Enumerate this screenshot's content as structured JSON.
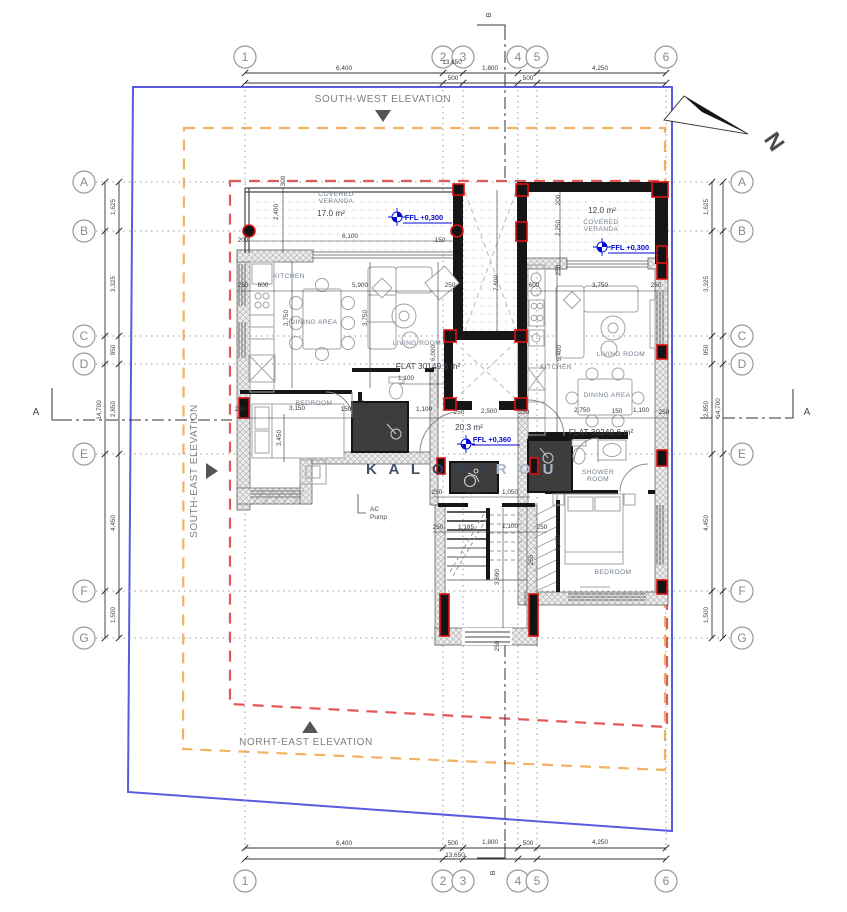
{
  "colors": {
    "boundary_blue": "#5a5ae0",
    "setback_orange": "#f2b263",
    "envelope_red": "#e65555",
    "ffl_blue": "#0009d0",
    "column_red": "#dd1111",
    "wall_black": "#161616"
  },
  "north": {
    "label": "N"
  },
  "sections": {
    "a": "A",
    "b": "B"
  },
  "elevations": {
    "south_west": "SOUTH-WEST ELEVATION",
    "north_east": "NORHT-EAST ELEVATION",
    "south_east": "SOUTH-EAST ELEVATION"
  },
  "watermark": {
    "strong": "K A L O G I",
    "faint": "R O U"
  },
  "ac_note": {
    "line1": "AC",
    "line2": "Pump"
  },
  "grid": {
    "cols": [
      {
        "label": "1",
        "x": 245
      },
      {
        "label": "2",
        "x": 443
      },
      {
        "label": "3",
        "x": 463
      },
      {
        "label": "4",
        "x": 518
      },
      {
        "label": "5",
        "x": 537
      },
      {
        "label": "6",
        "x": 666
      }
    ],
    "rows": [
      {
        "label": "A",
        "y": 182
      },
      {
        "label": "B",
        "y": 231
      },
      {
        "label": "C",
        "y": 336
      },
      {
        "label": "D",
        "y": 364
      },
      {
        "label": "E",
        "y": 454
      },
      {
        "label": "F",
        "y": 591
      },
      {
        "label": "G",
        "y": 638
      }
    ]
  },
  "dim_labels": [
    {
      "t": "6,400",
      "x": 344,
      "y": 70
    },
    {
      "t": "13,650",
      "x": 452,
      "y": 64
    },
    {
      "t": "500",
      "x": 453,
      "y": 80
    },
    {
      "t": "1,800",
      "x": 490,
      "y": 70
    },
    {
      "t": "500",
      "x": 528,
      "y": 80
    },
    {
      "t": "4,250",
      "x": 600,
      "y": 70
    },
    {
      "t": "6,400",
      "x": 344,
      "y": 845
    },
    {
      "t": "500",
      "x": 453,
      "y": 845
    },
    {
      "t": "1,800",
      "x": 490,
      "y": 844
    },
    {
      "t": "500",
      "x": 528,
      "y": 845
    },
    {
      "t": "4,250",
      "x": 600,
      "y": 844
    },
    {
      "t": "13,650",
      "x": 455,
      "y": 857
    },
    {
      "t": "1,625",
      "x": 115,
      "y": 207,
      "r": 1
    },
    {
      "t": "3,325",
      "x": 115,
      "y": 284,
      "r": 1
    },
    {
      "t": "950",
      "x": 115,
      "y": 350,
      "r": 1
    },
    {
      "t": "2,850",
      "x": 115,
      "y": 409,
      "r": 1
    },
    {
      "t": "4,450",
      "x": 115,
      "y": 523,
      "r": 1
    },
    {
      "t": "1,500",
      "x": 115,
      "y": 615,
      "r": 1
    },
    {
      "t": "14,700",
      "x": 101,
      "y": 410,
      "r": 1
    },
    {
      "t": "1,625",
      "x": 708,
      "y": 207,
      "r": 1
    },
    {
      "t": "3,325",
      "x": 708,
      "y": 284,
      "r": 1
    },
    {
      "t": "950",
      "x": 708,
      "y": 350,
      "r": 1
    },
    {
      "t": "2,850",
      "x": 708,
      "y": 409,
      "r": 1
    },
    {
      "t": "4,450",
      "x": 708,
      "y": 523,
      "r": 1
    },
    {
      "t": "1,500",
      "x": 708,
      "y": 615,
      "r": 1
    },
    {
      "t": "14,700",
      "x": 720,
      "y": 408,
      "r": 1
    },
    {
      "t": "300",
      "x": 285,
      "y": 181,
      "r": 1
    },
    {
      "t": "2,400",
      "x": 278,
      "y": 212,
      "r": 1
    },
    {
      "t": "6,100",
      "x": 350,
      "y": 238
    },
    {
      "t": "200",
      "x": 243,
      "y": 242
    },
    {
      "t": "150",
      "x": 440,
      "y": 242
    },
    {
      "t": "200",
      "x": 560,
      "y": 200,
      "r": 1
    },
    {
      "t": "2,250",
      "x": 560,
      "y": 228,
      "r": 1
    },
    {
      "t": "250",
      "x": 560,
      "y": 270,
      "r": 1
    },
    {
      "t": "250",
      "x": 243,
      "y": 287
    },
    {
      "t": "600",
      "x": 263,
      "y": 287
    },
    {
      "t": "5,900",
      "x": 360,
      "y": 287
    },
    {
      "t": "250",
      "x": 450,
      "y": 287
    },
    {
      "t": "600",
      "x": 534,
      "y": 287
    },
    {
      "t": "3,750",
      "x": 600,
      "y": 287
    },
    {
      "t": "250",
      "x": 656,
      "y": 287
    },
    {
      "t": "7,600",
      "x": 498,
      "y": 283,
      "r": 1
    },
    {
      "t": "3,750",
      "x": 288,
      "y": 318,
      "r": 1
    },
    {
      "t": "3,750",
      "x": 367,
      "y": 318,
      "r": 1
    },
    {
      "t": "6,000",
      "x": 435,
      "y": 353,
      "r": 1
    },
    {
      "t": "5,400",
      "x": 561,
      "y": 353,
      "r": 1
    },
    {
      "t": "1,100",
      "x": 406,
      "y": 380
    },
    {
      "t": "250",
      "x": 240,
      "y": 411
    },
    {
      "t": "3,150",
      "x": 297,
      "y": 410
    },
    {
      "t": "150",
      "x": 346,
      "y": 411
    },
    {
      "t": "1,600",
      "x": 379,
      "y": 411
    },
    {
      "t": "150",
      "x": 397,
      "y": 411
    },
    {
      "t": "1,100",
      "x": 424,
      "y": 411
    },
    {
      "t": "250",
      "x": 459,
      "y": 414
    },
    {
      "t": "2,500",
      "x": 489,
      "y": 413
    },
    {
      "t": "250",
      "x": 524,
      "y": 414
    },
    {
      "t": "2,750",
      "x": 582,
      "y": 412
    },
    {
      "t": "150",
      "x": 617,
      "y": 413
    },
    {
      "t": "1,100",
      "x": 641,
      "y": 412
    },
    {
      "t": "250",
      "x": 664,
      "y": 414
    },
    {
      "t": "3,450",
      "x": 281,
      "y": 438,
      "r": 1
    },
    {
      "t": "2,100",
      "x": 364,
      "y": 408,
      "r": 1
    },
    {
      "t": "250",
      "x": 437,
      "y": 494
    },
    {
      "t": "1,450",
      "x": 474,
      "y": 494
    },
    {
      "t": "1,050",
      "x": 510,
      "y": 494
    },
    {
      "t": "250",
      "x": 438,
      "y": 529
    },
    {
      "t": "1,185",
      "x": 466,
      "y": 529
    },
    {
      "t": "1,100",
      "x": 510,
      "y": 528
    },
    {
      "t": "250",
      "x": 542,
      "y": 529
    },
    {
      "t": "3,690",
      "x": 499,
      "y": 577,
      "r": 1
    },
    {
      "t": "250",
      "x": 499,
      "y": 646,
      "r": 1
    },
    {
      "t": "3,100",
      "x": 560,
      "y": 543,
      "r": 1
    },
    {
      "t": "250",
      "x": 533,
      "y": 560,
      "r": 1
    }
  ],
  "plan_labels": [
    {
      "t": "COVERED",
      "x": 336,
      "y": 196,
      "c": "room"
    },
    {
      "t": "VERANDA",
      "x": 336,
      "y": 203,
      "c": "room"
    },
    {
      "t": "17.0 m²",
      "x": 331,
      "y": 216,
      "c": "area"
    },
    {
      "t": "12.0 m²",
      "x": 602,
      "y": 213,
      "c": "area"
    },
    {
      "t": "COVERED",
      "x": 601,
      "y": 224,
      "c": "room"
    },
    {
      "t": "VERANDA",
      "x": 601,
      "y": 231,
      "c": "room"
    },
    {
      "t": "KITCHEN",
      "x": 289,
      "y": 278,
      "c": "room"
    },
    {
      "t": "DINING AREA",
      "x": 314,
      "y": 324,
      "c": "room"
    },
    {
      "t": "LIVING ROOM",
      "x": 417,
      "y": 345,
      "c": "room"
    },
    {
      "t": "BEDROOM",
      "x": 314,
      "y": 405,
      "c": "room"
    },
    {
      "t": "KITCHEN",
      "x": 556,
      "y": 369,
      "c": "room"
    },
    {
      "t": "LIVING ROOM",
      "x": 621,
      "y": 356,
      "c": "room"
    },
    {
      "t": "DINING AREA",
      "x": 607,
      "y": 397,
      "c": "room"
    },
    {
      "t": "SHOWER",
      "x": 598,
      "y": 474,
      "c": "room"
    },
    {
      "t": "ROOM",
      "x": 598,
      "y": 481,
      "c": "room"
    },
    {
      "t": "BEDROOM",
      "x": 613,
      "y": 574,
      "c": "room"
    },
    {
      "t": "20.3 m²",
      "x": 469,
      "y": 430,
      "c": "area"
    },
    {
      "t": "FLAT 30149.6 m²",
      "x": 428,
      "y": 369,
      "c": "flat"
    },
    {
      "t": "FLAT 30249.6 m²",
      "x": 601,
      "y": 435,
      "c": "flat"
    },
    {
      "t": "FFL +0,300",
      "x": 424,
      "y": 220,
      "c": "ffl"
    },
    {
      "t": "FFL +0,300",
      "x": 630,
      "y": 250,
      "c": "ffl"
    },
    {
      "t": "FFL +0,360",
      "x": 492,
      "y": 442,
      "c": "ffl"
    }
  ]
}
